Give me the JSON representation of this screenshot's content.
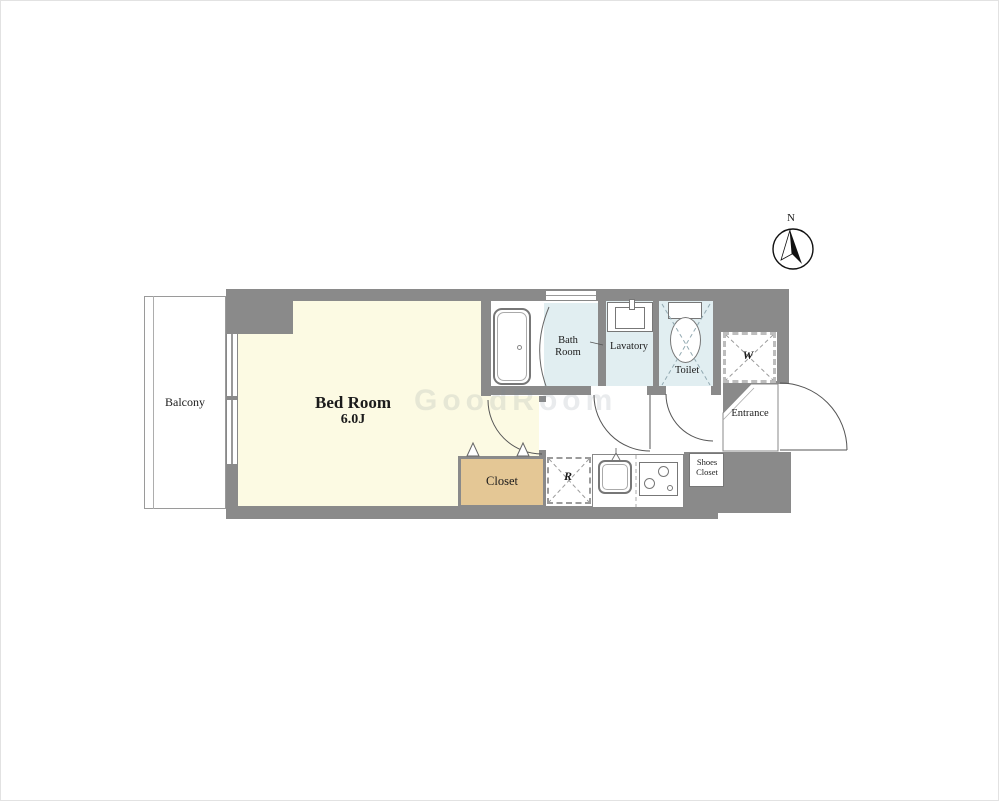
{
  "compass": {
    "north_label": "N"
  },
  "watermark": {
    "text": "GoodRoom"
  },
  "colors": {
    "wall": "#8a8a8a",
    "bedroom_fill": "#fcfae3",
    "wet_area_fill": "#e1eef1",
    "closet_fill": "#e4c795",
    "floor_white": "#ffffff"
  },
  "labels": {
    "balcony": "Balcony",
    "bedroom_name": "Bed Room",
    "bedroom_size": "6.0J",
    "bath": "Bath Room",
    "lavatory": "Lavatory",
    "toilet": "Toilet",
    "washer": "W",
    "entrance": "Entrance",
    "shoes_closet": "Shoes Closet",
    "closet": "Closet",
    "refrigerator": "R"
  }
}
